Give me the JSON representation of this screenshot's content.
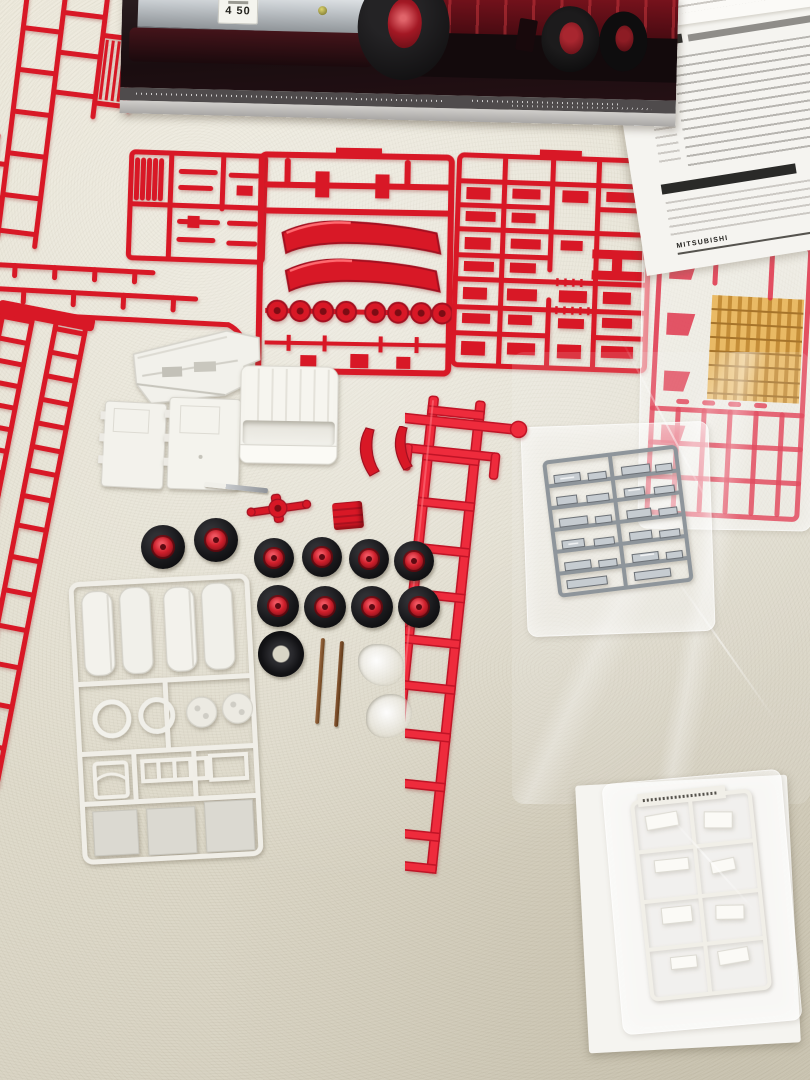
{
  "scene": {
    "type": "photograph",
    "description": "Unassembled Japanese fire-truck plastic model kit spread on a cream pebbled-leather sofa: box lid photo of the truck at top, folded instruction sheet top right, six red sprues, red ladder chassis frame, white cab and tank parts, ten rubber tires with red hubs, one bare tire, two metal axle rods, chrome-plated sprue and white sprue sealed in bags, clear-red and amber sprue in a bag",
    "surface": "cream pebbled leather",
    "palette": {
      "leather": "#e7e3d4",
      "red_plastic": "#d81826",
      "chassis_red": "#ee2b3c",
      "white_plastic": "#f3f2ec",
      "chrome_plated": "#a6adb3",
      "clear_amber": "#e2a23a",
      "tire_black": "#1a1a1d",
      "hub_red": "#d02231",
      "box_photo_background": "#1c1113",
      "paper": "#f6f5f1"
    }
  },
  "box_lid": {
    "subject": "red fire truck with chrome bumper, black tires, red steel wheels",
    "license_plate_number": "4 50"
  },
  "instructions": {
    "appearance": "white sheet dense with small Japanese text and black section bars",
    "brand_text": "MITSUBISHI"
  },
  "counts": {
    "road_wheels_with_red_hubs": 10,
    "bare_tires": 1,
    "axle_rods": 2,
    "air_tank_parts_on_white_sprue": 4,
    "fender_parts_on_center_sprue": 2,
    "hub_caps_on_center_sprue": 8,
    "red_sprues": 6,
    "bagged_sprues": 3
  },
  "items": [
    {
      "id": "box-lid",
      "label": "kit box lid with truck photo"
    },
    {
      "id": "instruction-sheet",
      "label": "folded instruction sheet"
    },
    {
      "id": "sprue-top-left",
      "label": "red sprue with frame rails and grille"
    },
    {
      "id": "sprue-ladder-left",
      "label": "long red sprue with ladder sections"
    },
    {
      "id": "sprue-center-small",
      "label": "red sprue with small fittings"
    },
    {
      "id": "sprue-center-fenders",
      "label": "red sprue with fenders and hub caps"
    },
    {
      "id": "sprue-right-dense",
      "label": "dense red sprue with chassis fittings"
    },
    {
      "id": "sprue-clear-red-amber",
      "label": "bagged clear-red sprue with amber light parts"
    },
    {
      "id": "chassis-frame",
      "label": "red ladder chassis frame"
    },
    {
      "id": "cab-shell",
      "label": "white cab shell"
    },
    {
      "id": "door-panels",
      "label": "two white door panels"
    },
    {
      "id": "interior-tub",
      "label": "white stepped interior part"
    },
    {
      "id": "white-sprue-tanks",
      "label": "white sprue with tanks, rings and panels"
    },
    {
      "id": "chrome-sprue-bagged",
      "label": "bagged chrome-plated sprue"
    },
    {
      "id": "white-sprue-bagged",
      "label": "bagged white sprue on paper"
    },
    {
      "id": "wheels",
      "label": "black tires with red hubs"
    },
    {
      "id": "axle-rods",
      "label": "two metal axle rods"
    },
    {
      "id": "clear-small-parts",
      "label": "clusters of small clear parts"
    }
  ]
}
